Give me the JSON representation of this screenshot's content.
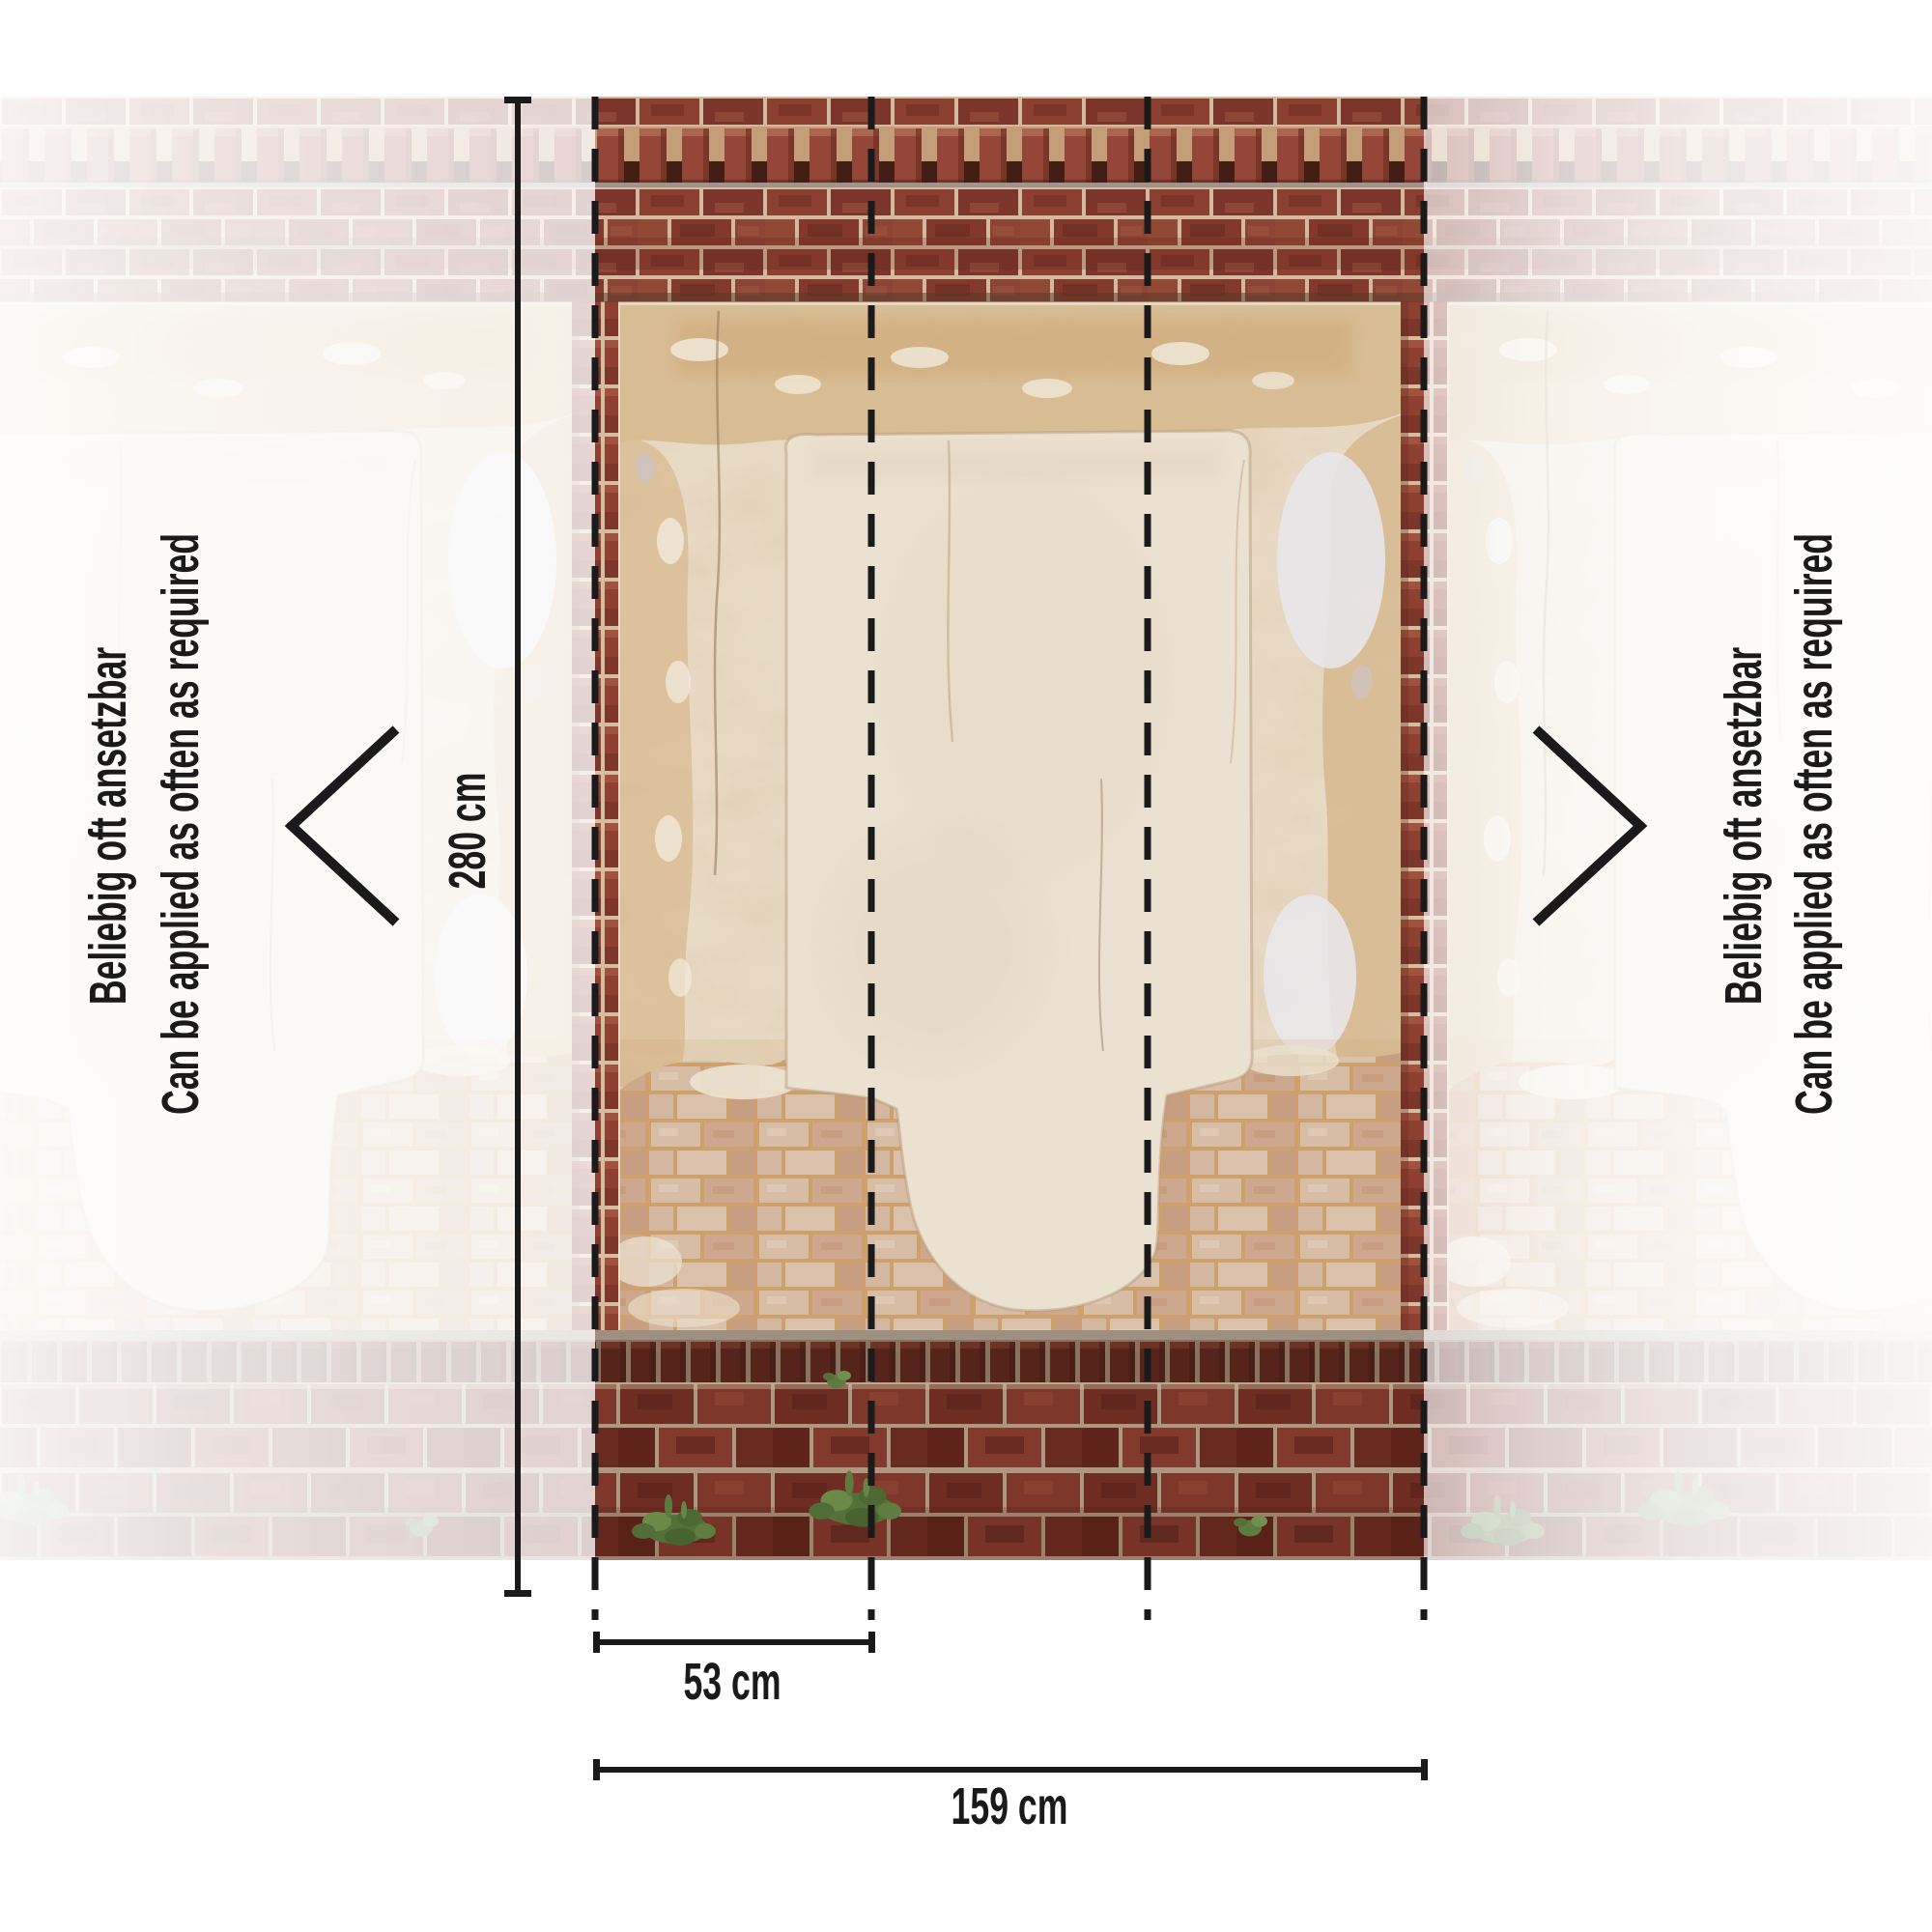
{
  "repeat_note": {
    "de": "Beliebig oft ansetzbar",
    "en": "Can be applied as often as required"
  },
  "dimensions": {
    "height": "280 cm",
    "panel_width": "53 cm",
    "total_width": "159 cm",
    "panel_count": 3
  },
  "colors": {
    "ink": "#1a1a1a",
    "background": "#ffffff",
    "brick_red": "#8d4133",
    "brick_dark": "#6e2d23",
    "light_brick": "#d5bba9",
    "plaster_cream": "#e8dbc6",
    "plaster_tan": "#d6b98e",
    "plant_green": "#55713a"
  }
}
